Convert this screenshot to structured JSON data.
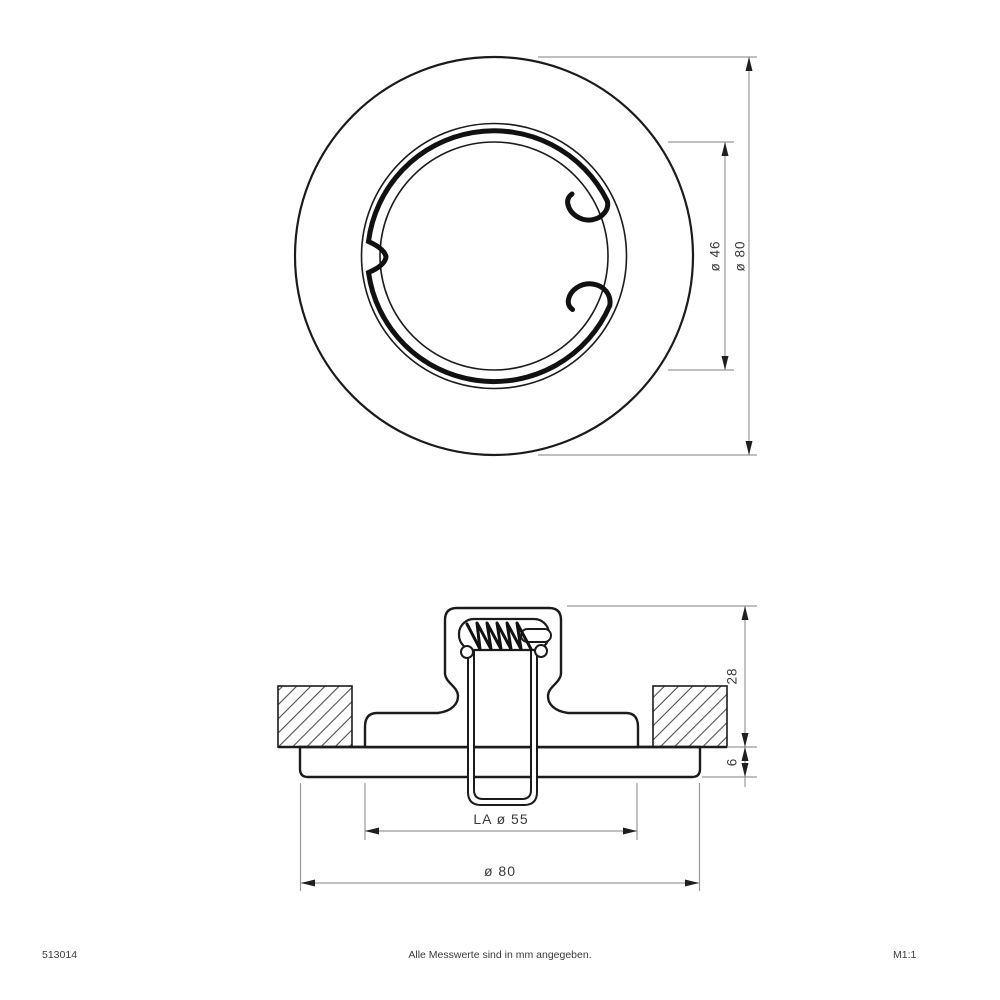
{
  "drawing": {
    "type": "technical-dimension-drawing",
    "subject": "recessed-downlight-mounting-ring",
    "colors": {
      "background": "#ffffff",
      "outline": "#1b1b1b",
      "dimension_line": "#999999",
      "arrow": "#1f1f1f",
      "text": "#3a3a3a",
      "hatch": "#4d4d4d"
    }
  },
  "top_view": {
    "dim_inner_diameter": "ø 46",
    "dim_outer_diameter": "ø 80"
  },
  "side_view": {
    "dim_height": "28",
    "dim_plate_thickness": "6",
    "dim_cutout": "LA ø 55",
    "dim_outer_diameter": "ø 80"
  },
  "footer": {
    "article_number": "513014",
    "note": "Alle Messwerte sind in mm angegeben.",
    "scale": "M1:1"
  }
}
